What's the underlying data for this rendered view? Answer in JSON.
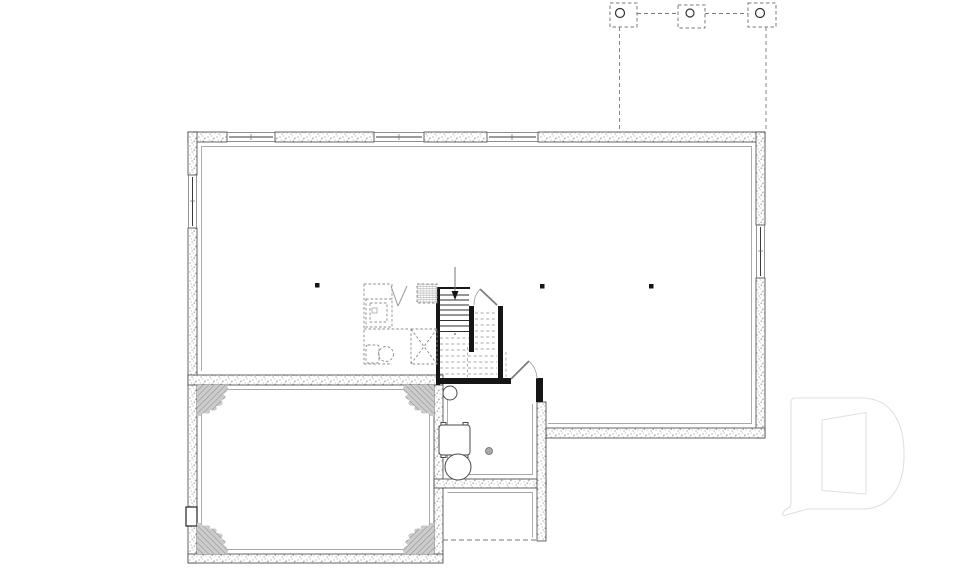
{
  "document": {
    "kind": "basement-floor-plan",
    "visible_text": [],
    "canvas": {
      "width": 960,
      "height": 569,
      "background": "#ffffff"
    }
  },
  "colors": {
    "wall_outline": "#3f3f3f",
    "interior_wall": "#161616",
    "tread": "#2e2e2e",
    "dashed_hidden": "#a8a8a8",
    "dashed_fixture": "#8c8c8c",
    "door": "#7d7d7d",
    "door_arc": "#9b9b9b",
    "fixture_outline": "#4a4a4a",
    "furring": "#8a8a8a",
    "deck_dash": "#7a7a7a",
    "logo": "#e0e0e0",
    "paper": "#ffffff"
  },
  "plan": {
    "deck_above": {
      "posts": 3,
      "style": "dashed squares with round columns, dashed outline projected onto foundation"
    },
    "foundation": {
      "material": "stippled concrete wall",
      "windows": {
        "top_wall": 3,
        "left_wall": 1,
        "right_wall": 1,
        "cellar_left_wall": 1
      }
    },
    "support_columns": 3,
    "stair": {
      "direction": "down",
      "solid_treads": 8,
      "hidden_treads_dashed": true
    },
    "doors": [
      "stair-closet-door",
      "mechanical-room-door"
    ],
    "future_bathroom_dashed": [
      "vanity-counter",
      "sink",
      "door-swing",
      "vent-chase",
      "shower-x-box",
      "toilet"
    ],
    "mechanical_room_fixtures": [
      "pressure-tank",
      "laundry-tub",
      "floor-drain",
      "water-heater"
    ],
    "unexcavated_corner_hatches": 4,
    "logo": {
      "name": "d-monogram-logo",
      "aria": "builder D monogram watermark"
    }
  },
  "aria": {
    "plan": "Basement floor plan drawing",
    "logo": "Builder D monogram watermark"
  }
}
